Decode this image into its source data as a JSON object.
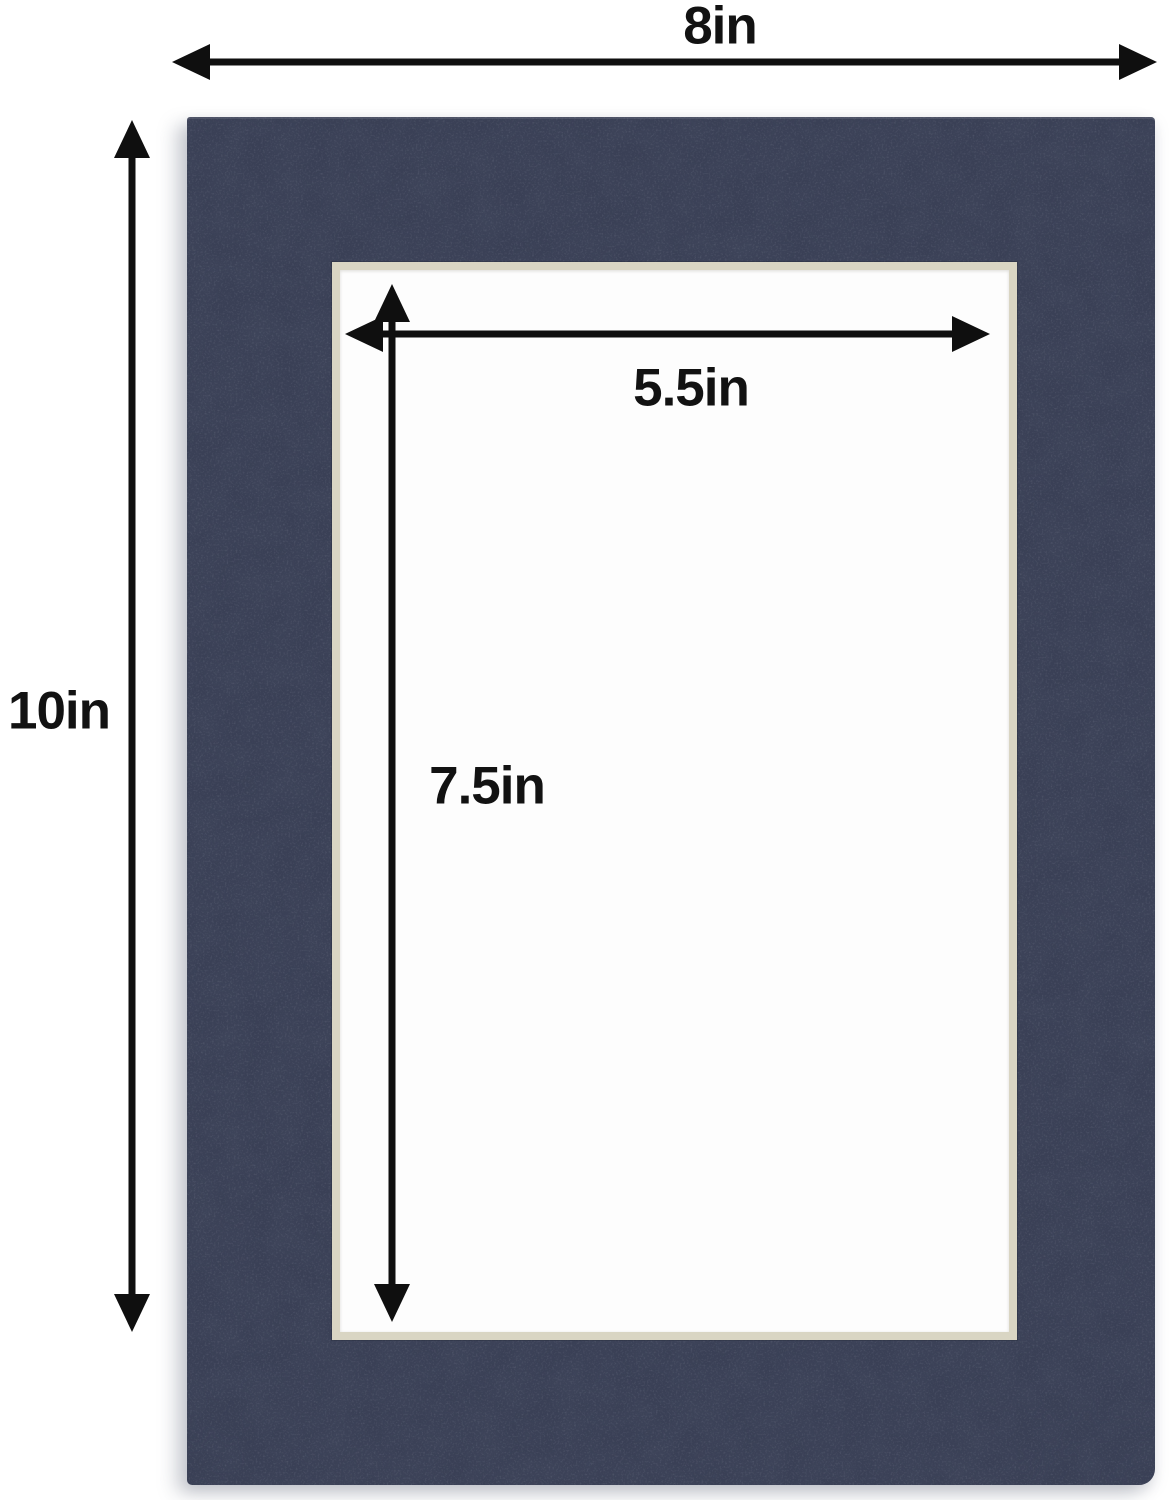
{
  "labels": {
    "outer_width": "8in",
    "outer_height": "10in",
    "opening_width": "5.5in",
    "opening_height": "7.5in"
  },
  "colors": {
    "background": "#ffffff",
    "mat_navy": "#3a4056",
    "mat_navy_dark": "#333949",
    "bevel_cream": "#d9d5c3",
    "bevel_edge": "#b9b5a3",
    "opening_white": "#fdfdfd",
    "arrow_black": "#0f0f0f",
    "label_black": "#121212"
  },
  "diagram": {
    "type": "product-dimension-diagram",
    "subject": "navy blue picture mat board with rectangular opening",
    "outer_dimensions": {
      "width_in": 8,
      "height_in": 10
    },
    "opening_dimensions": {
      "width_in": 5.5,
      "height_in": 7.5
    }
  }
}
